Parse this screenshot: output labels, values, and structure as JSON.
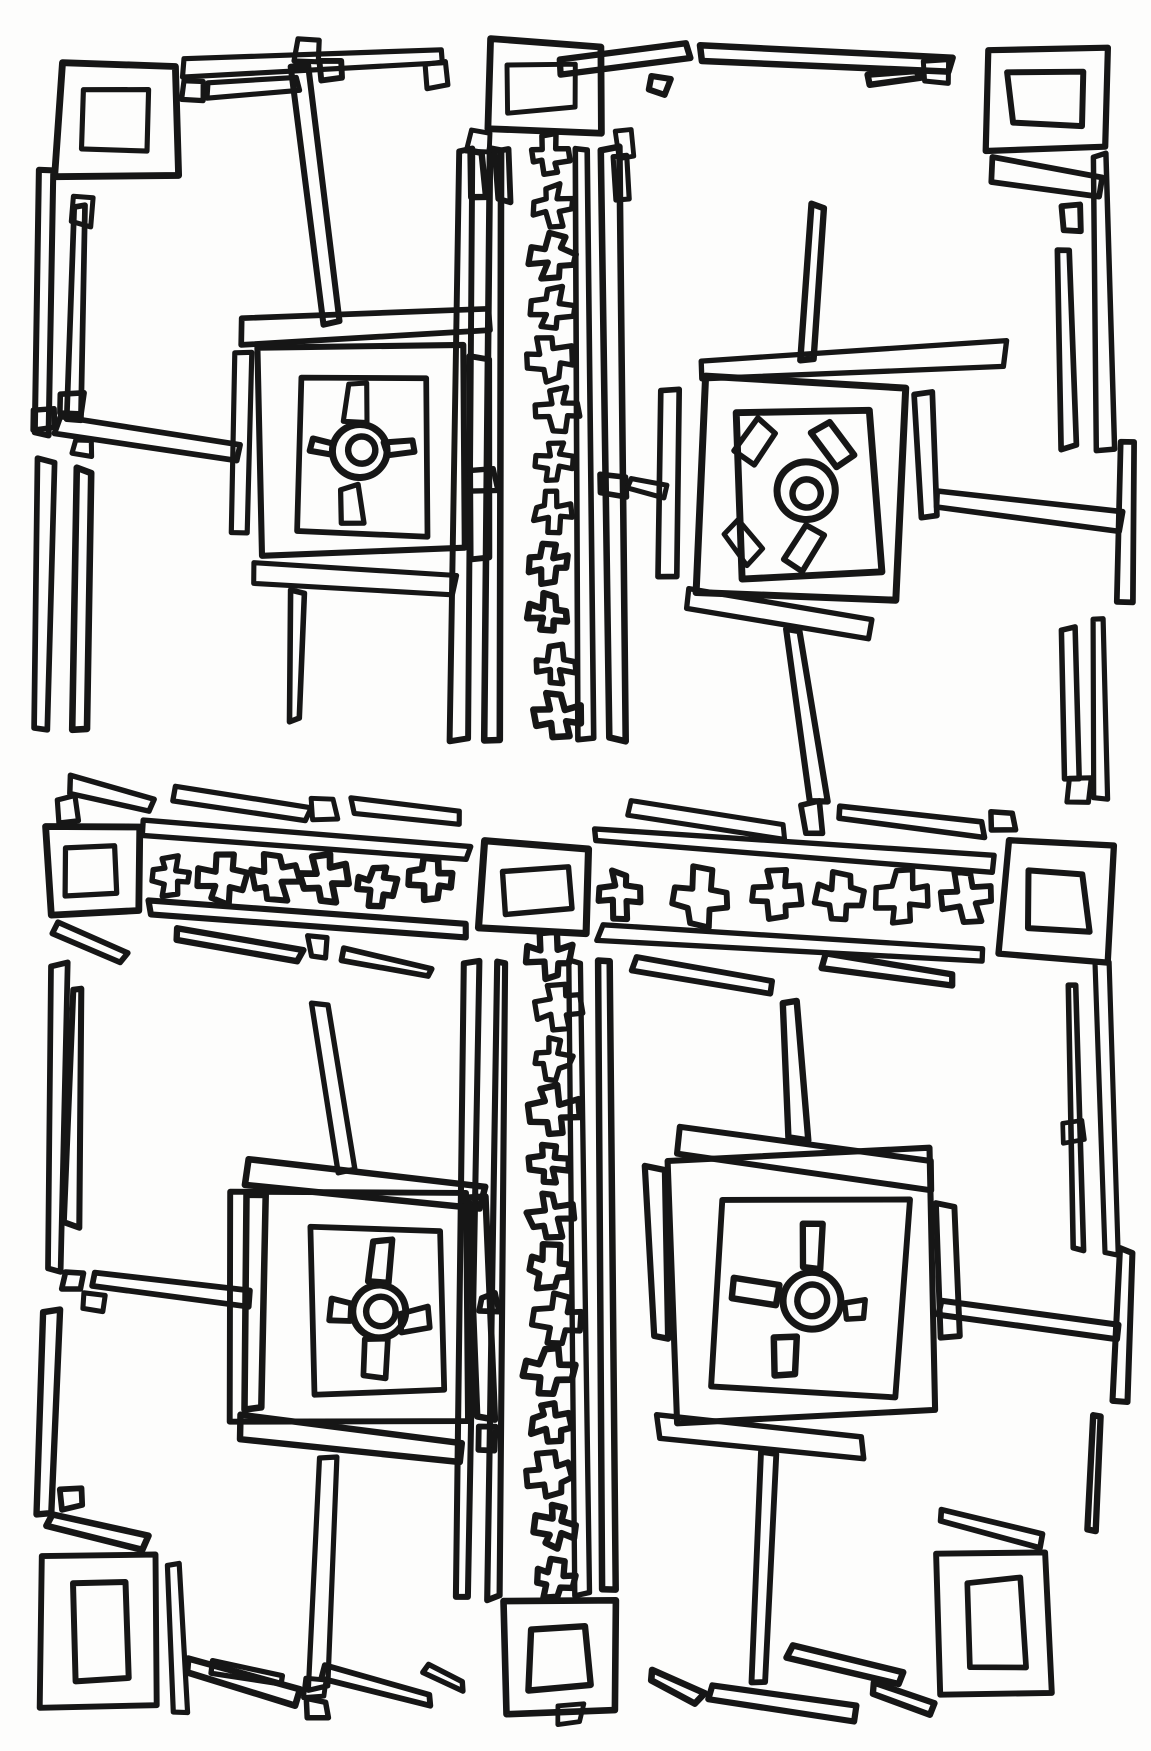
{
  "style": {
    "background": "#fdfdfc",
    "ink": "#161616",
    "stroke_width": 7
  },
  "double_squares": [
    [
      58,
      63,
      118,
      112
    ],
    [
      487,
      42,
      112,
      92
    ],
    [
      985,
      47,
      122,
      103
    ],
    [
      47,
      827,
      90,
      85
    ],
    [
      481,
      846,
      108,
      84
    ],
    [
      1004,
      845,
      108,
      112
    ],
    [
      44,
      1556,
      112,
      152
    ],
    [
      506,
      1601,
      108,
      112
    ],
    [
      940,
      1554,
      108,
      140
    ]
  ],
  "small_squares": [
    [
      182,
      80,
      22,
      20
    ],
    [
      297,
      40,
      21,
      21
    ],
    [
      322,
      61,
      21,
      19
    ],
    [
      427,
      63,
      19,
      23
    ],
    [
      648,
      75,
      20,
      18
    ],
    [
      925,
      62,
      22,
      20
    ],
    [
      1062,
      206,
      19,
      23
    ],
    [
      72,
      198,
      22,
      26
    ],
    [
      33,
      408,
      22,
      20
    ],
    [
      61,
      394,
      20,
      18
    ],
    [
      74,
      441,
      16,
      14
    ],
    [
      468,
      130,
      23,
      23
    ],
    [
      616,
      131,
      18,
      26
    ],
    [
      470,
      468,
      26,
      24
    ],
    [
      600,
      474,
      26,
      21
    ],
    [
      1068,
      780,
      22,
      20
    ],
    [
      58,
      798,
      18,
      24
    ],
    [
      313,
      799,
      22,
      20
    ],
    [
      310,
      937,
      18,
      20
    ],
    [
      804,
      804,
      17,
      30
    ],
    [
      993,
      812,
      20,
      20
    ],
    [
      63,
      1272,
      20,
      18
    ],
    [
      85,
      1294,
      18,
      16
    ],
    [
      62,
      1488,
      20,
      20
    ],
    [
      480,
      1295,
      16,
      16
    ],
    [
      477,
      1427,
      18,
      23
    ],
    [
      1062,
      1120,
      19,
      22
    ],
    [
      305,
      1678,
      18,
      18
    ],
    [
      307,
      1700,
      20,
      18
    ],
    [
      560,
      1706,
      22,
      18
    ]
  ],
  "bars": [
    [
      185,
      70,
      440,
      56,
      18
    ],
    [
      207,
      92,
      298,
      84,
      13
    ],
    [
      560,
      66,
      688,
      52,
      16
    ],
    [
      700,
      52,
      950,
      66,
      15
    ],
    [
      868,
      78,
      918,
      74,
      10
    ],
    [
      992,
      170,
      1098,
      186,
      22
    ],
    [
      48,
      170,
      43,
      435,
      15
    ],
    [
      78,
      205,
      73,
      420,
      12
    ],
    [
      45,
      460,
      40,
      730,
      15
    ],
    [
      85,
      470,
      80,
      728,
      12
    ],
    [
      58,
      424,
      240,
      452,
      16
    ],
    [
      1100,
      155,
      1106,
      450,
      16
    ],
    [
      1062,
      250,
      1067,
      448,
      13
    ],
    [
      935,
      500,
      1122,
      522,
      15
    ],
    [
      1128,
      444,
      1123,
      600,
      14
    ],
    [
      1068,
      630,
      1072,
      780,
      13
    ],
    [
      1098,
      618,
      1102,
      800,
      14
    ],
    [
      70,
      784,
      150,
      806,
      15
    ],
    [
      174,
      792,
      308,
      816,
      14
    ],
    [
      352,
      806,
      460,
      818,
      11
    ],
    [
      145,
      830,
      468,
      852,
      16
    ],
    [
      150,
      908,
      466,
      930,
      16
    ],
    [
      175,
      934,
      300,
      956,
      13
    ],
    [
      342,
      952,
      428,
      972,
      12
    ],
    [
      57,
      928,
      122,
      958,
      14
    ],
    [
      597,
      835,
      995,
      862,
      17
    ],
    [
      600,
      930,
      980,
      956,
      16
    ],
    [
      630,
      810,
      783,
      830,
      13
    ],
    [
      837,
      812,
      983,
      830,
      12
    ],
    [
      633,
      962,
      770,
      985,
      13
    ],
    [
      822,
      962,
      953,
      980,
      12
    ],
    [
      466,
      150,
      459,
      740,
      14
    ],
    [
      497,
      148,
      491,
      741,
      13
    ],
    [
      580,
      150,
      586,
      741,
      12
    ],
    [
      610,
      148,
      617,
      740,
      13
    ],
    [
      478,
      152,
      478,
      198,
      13
    ],
    [
      503,
      150,
      503,
      200,
      13
    ],
    [
      622,
      158,
      622,
      200,
      12
    ],
    [
      470,
      963,
      463,
      1597,
      14
    ],
    [
      501,
      961,
      494,
      1598,
      13
    ],
    [
      575,
      962,
      581,
      1594,
      12
    ],
    [
      604,
      962,
      611,
      1590,
      13
    ],
    [
      60,
      965,
      53,
      1270,
      15
    ],
    [
      78,
      990,
      72,
      1225,
      12
    ],
    [
      50,
      1310,
      44,
      1512,
      15
    ],
    [
      48,
      1520,
      145,
      1545,
      14
    ],
    [
      172,
      1565,
      180,
      1712,
      15
    ],
    [
      188,
      1668,
      298,
      1698,
      15
    ],
    [
      212,
      1666,
      280,
      1682,
      10
    ],
    [
      322,
      1674,
      430,
      1700,
      14
    ],
    [
      425,
      1670,
      462,
      1686,
      10
    ],
    [
      652,
      1676,
      700,
      1700,
      12
    ],
    [
      712,
      1690,
      858,
      1712,
      14
    ],
    [
      790,
      1652,
      900,
      1680,
      13
    ],
    [
      875,
      1690,
      933,
      1707,
      11
    ],
    [
      1103,
      965,
      1109,
      1255,
      14
    ],
    [
      1072,
      985,
      1078,
      1248,
      12
    ],
    [
      1126,
      1250,
      1121,
      1402,
      13
    ],
    [
      1097,
      1415,
      1091,
      1528,
      13
    ],
    [
      942,
      1515,
      1042,
      1540,
      14
    ]
  ],
  "cross_columns": [
    {
      "x": 553,
      "size": 44,
      "ys": [
        155,
        206,
        257,
        308,
        359,
        410,
        461,
        512,
        563,
        614,
        665,
        716
      ]
    },
    {
      "x": 553,
      "size": 46,
      "ys": [
        955,
        1007,
        1059,
        1111,
        1163,
        1215,
        1267,
        1319,
        1371,
        1423,
        1475,
        1527,
        1579
      ]
    }
  ],
  "cross_rows": [
    {
      "y": 880,
      "size": 46,
      "xs": [
        170,
        222,
        275,
        325,
        377,
        430
      ]
    },
    {
      "y": 893,
      "size": 54,
      "xs": [
        620,
        700,
        777,
        840,
        903,
        967
      ]
    }
  ],
  "medallions": [
    {
      "name": "top-left",
      "outer": [
        262,
        347,
        200,
        205,
        -1
      ],
      "inner": [
        303,
        376,
        122,
        160,
        1
      ],
      "ring": {
        "cx": 360,
        "cy": 452,
        "ro": 26,
        "ri": 13
      },
      "marks": [
        [
          347,
          384,
          20,
          36,
          4
        ],
        [
          340,
          487,
          20,
          36,
          -6
        ],
        [
          311,
          440,
          22,
          12,
          18
        ],
        [
          386,
          441,
          28,
          14,
          -10
        ]
      ],
      "bars": [
        [
          240,
          330,
          487,
          318,
          24
        ],
        [
          243,
          352,
          239,
          532,
          20
        ],
        [
          478,
          357,
          482,
          557,
          20
        ],
        [
          300,
          65,
          332,
          322,
          17
        ],
        [
          255,
          572,
          455,
          586,
          20
        ],
        [
          300,
          592,
          295,
          720,
          14
        ]
      ]
    },
    {
      "name": "top-right",
      "outer": [
        697,
        383,
        206,
        216,
        2
      ],
      "inner": [
        735,
        410,
        140,
        163,
        -2
      ],
      "ring": {
        "cx": 806,
        "cy": 492,
        "ro": 28,
        "ri": 14
      },
      "marks": [
        [
          745,
          422,
          22,
          38,
          35
        ],
        [
          820,
          424,
          24,
          40,
          -38
        ],
        [
          732,
          524,
          22,
          38,
          -40
        ],
        [
          794,
          527,
          22,
          42,
          30
        ]
      ],
      "bars": [
        [
          702,
          370,
          1005,
          354,
          22
        ],
        [
          818,
          207,
          806,
          358,
          17
        ],
        [
          670,
          390,
          666,
          578,
          18
        ],
        [
          628,
          483,
          663,
          494,
          13
        ],
        [
          922,
          395,
          927,
          515,
          17
        ],
        [
          688,
          600,
          872,
          628,
          20
        ],
        [
          793,
          630,
          818,
          802,
          16
        ]
      ]
    },
    {
      "name": "bottom-left",
      "outer": [
        233,
        1192,
        235,
        228,
        1
      ],
      "inner": [
        316,
        1230,
        128,
        162,
        -1
      ],
      "ring": {
        "cx": 380,
        "cy": 1312,
        "ro": 27,
        "ri": 14
      },
      "marks": [
        [
          370,
          1241,
          22,
          42,
          5
        ],
        [
          366,
          1340,
          21,
          38,
          3
        ],
        [
          330,
          1302,
          22,
          17,
          6
        ],
        [
          402,
          1310,
          28,
          18,
          -8
        ]
      ],
      "bars": [
        [
          245,
          1172,
          483,
          1198,
          22
        ],
        [
          322,
          1004,
          349,
          1172,
          16
        ],
        [
          258,
          1196,
          254,
          1408,
          18
        ],
        [
          95,
          1278,
          250,
          1300,
          15
        ],
        [
          479,
          1198,
          484,
          1418,
          17
        ],
        [
          240,
          1428,
          460,
          1452,
          22
        ],
        [
          330,
          1458,
          318,
          1688,
          16
        ]
      ]
    },
    {
      "name": "bottom-right",
      "outer": [
        668,
        1153,
        265,
        262,
        -2
      ],
      "inner": [
        714,
        1200,
        188,
        192,
        2
      ],
      "ring": {
        "cx": 812,
        "cy": 1302,
        "ro": 28,
        "ri": 15
      },
      "marks": [
        [
          803,
          1222,
          20,
          46,
          3
        ],
        [
          733,
          1281,
          46,
          22,
          8
        ],
        [
          845,
          1300,
          19,
          18,
          -6
        ],
        [
          776,
          1337,
          20,
          38,
          -3
        ]
      ],
      "bars": [
        [
          677,
          1142,
          930,
          1176,
          26
        ],
        [
          790,
          1002,
          798,
          1138,
          17
        ],
        [
          656,
          1168,
          660,
          1338,
          17
        ],
        [
          944,
          1205,
          949,
          1338,
          16
        ],
        [
          938,
          1308,
          1118,
          1330,
          14
        ],
        [
          658,
          1426,
          862,
          1448,
          22
        ],
        [
          768,
          1452,
          760,
          1680,
          16
        ]
      ]
    }
  ]
}
